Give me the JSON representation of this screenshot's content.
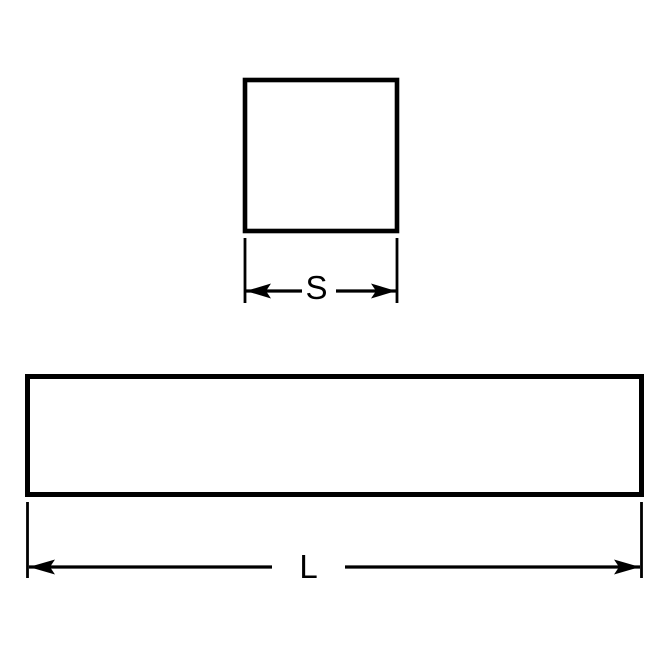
{
  "page": {
    "background": "#ffffff"
  },
  "diagram": {
    "type": "technical-drawing",
    "subject": "square-keysteel-profile",
    "ink_color": "#000000",
    "cross_section": {
      "shape": "square",
      "dimension_label": "S"
    },
    "side_view": {
      "shape": "rectangle",
      "dimension_label": "L"
    }
  }
}
